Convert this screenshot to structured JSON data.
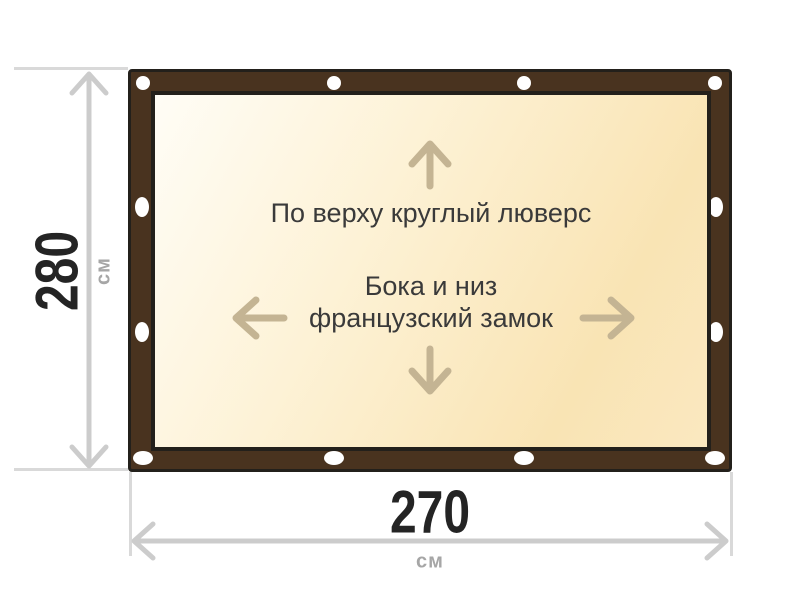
{
  "panel": {
    "top_note": "По верху круглый люверс",
    "middle_note_line1": "Бока и низ",
    "middle_note_line2": "французский замок"
  },
  "dimensions": {
    "height": {
      "value": "280",
      "unit": "см"
    },
    "width": {
      "value": "270",
      "unit": "см"
    }
  },
  "icons": {
    "up_arrow_icon": "↑",
    "down_arrow_icon": "↓",
    "left_arrow_icon": "←",
    "right_arrow_icon": "→",
    "grommet_icon": "⬭"
  },
  "colors": {
    "frame_brown": "#49331f",
    "outline_dark": "#23201b",
    "panel_light": "#fffdf6",
    "panel_mid": "#fdf2d6",
    "panel_gold": "#f9e4b4",
    "panel_gold2": "#fae8c0",
    "grommet_white": "#ffffff",
    "arrow_tan": "#c4b493",
    "note_text": "#3a3a3a",
    "dim_line": "#cccccc",
    "ext_line": "#d9d9d9",
    "dim_number": "#242424",
    "dim_unit": "#a6a6a6",
    "background": "#ffffff"
  }
}
